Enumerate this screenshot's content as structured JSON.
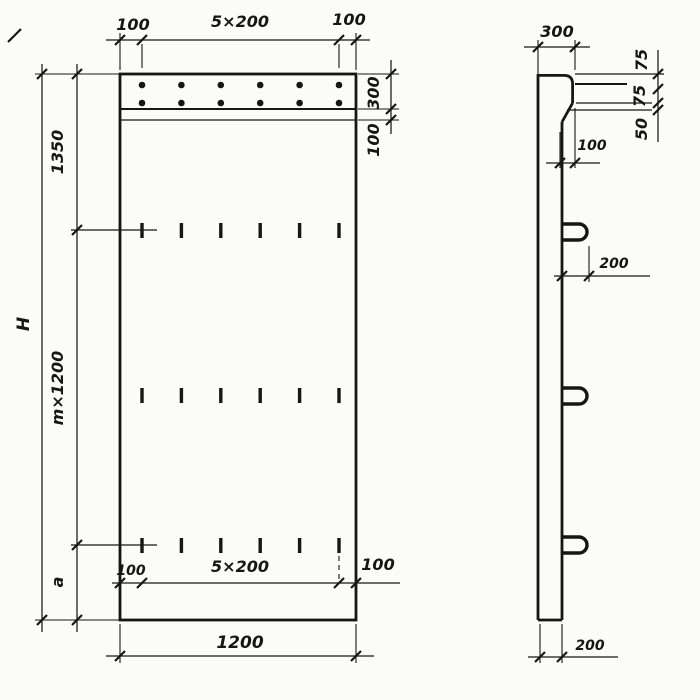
{
  "drawing": {
    "type": "technical-dimension-drawing",
    "ink_color": "#161616",
    "paper_color": "#fbfbf8",
    "front_view": {
      "top_dims": {
        "left": "100",
        "center": "5×200",
        "right": "100"
      },
      "left_dims": {
        "overall": "H",
        "upper": "1350",
        "middle": "m×1200",
        "lower": "a"
      },
      "right_dims": {
        "band": "300",
        "strip": "100"
      },
      "bottom_inner_dims": {
        "left": "100",
        "center": "5×200",
        "right": "100"
      },
      "bottom_dims": {
        "overall": "1200"
      },
      "features": {
        "anchor_dot_rows": 2,
        "anchor_dots_per_row": 6,
        "slot_rows": 3,
        "slots_per_row": 6
      }
    },
    "side_view": {
      "top_dim": "300",
      "ledge_dims": {
        "upper": "75",
        "middle": "75",
        "lower": "50",
        "offset": "100"
      },
      "loop_offset_dim": "200",
      "bottom_dim": "200",
      "features": {
        "lifting_loops": 3
      }
    }
  }
}
